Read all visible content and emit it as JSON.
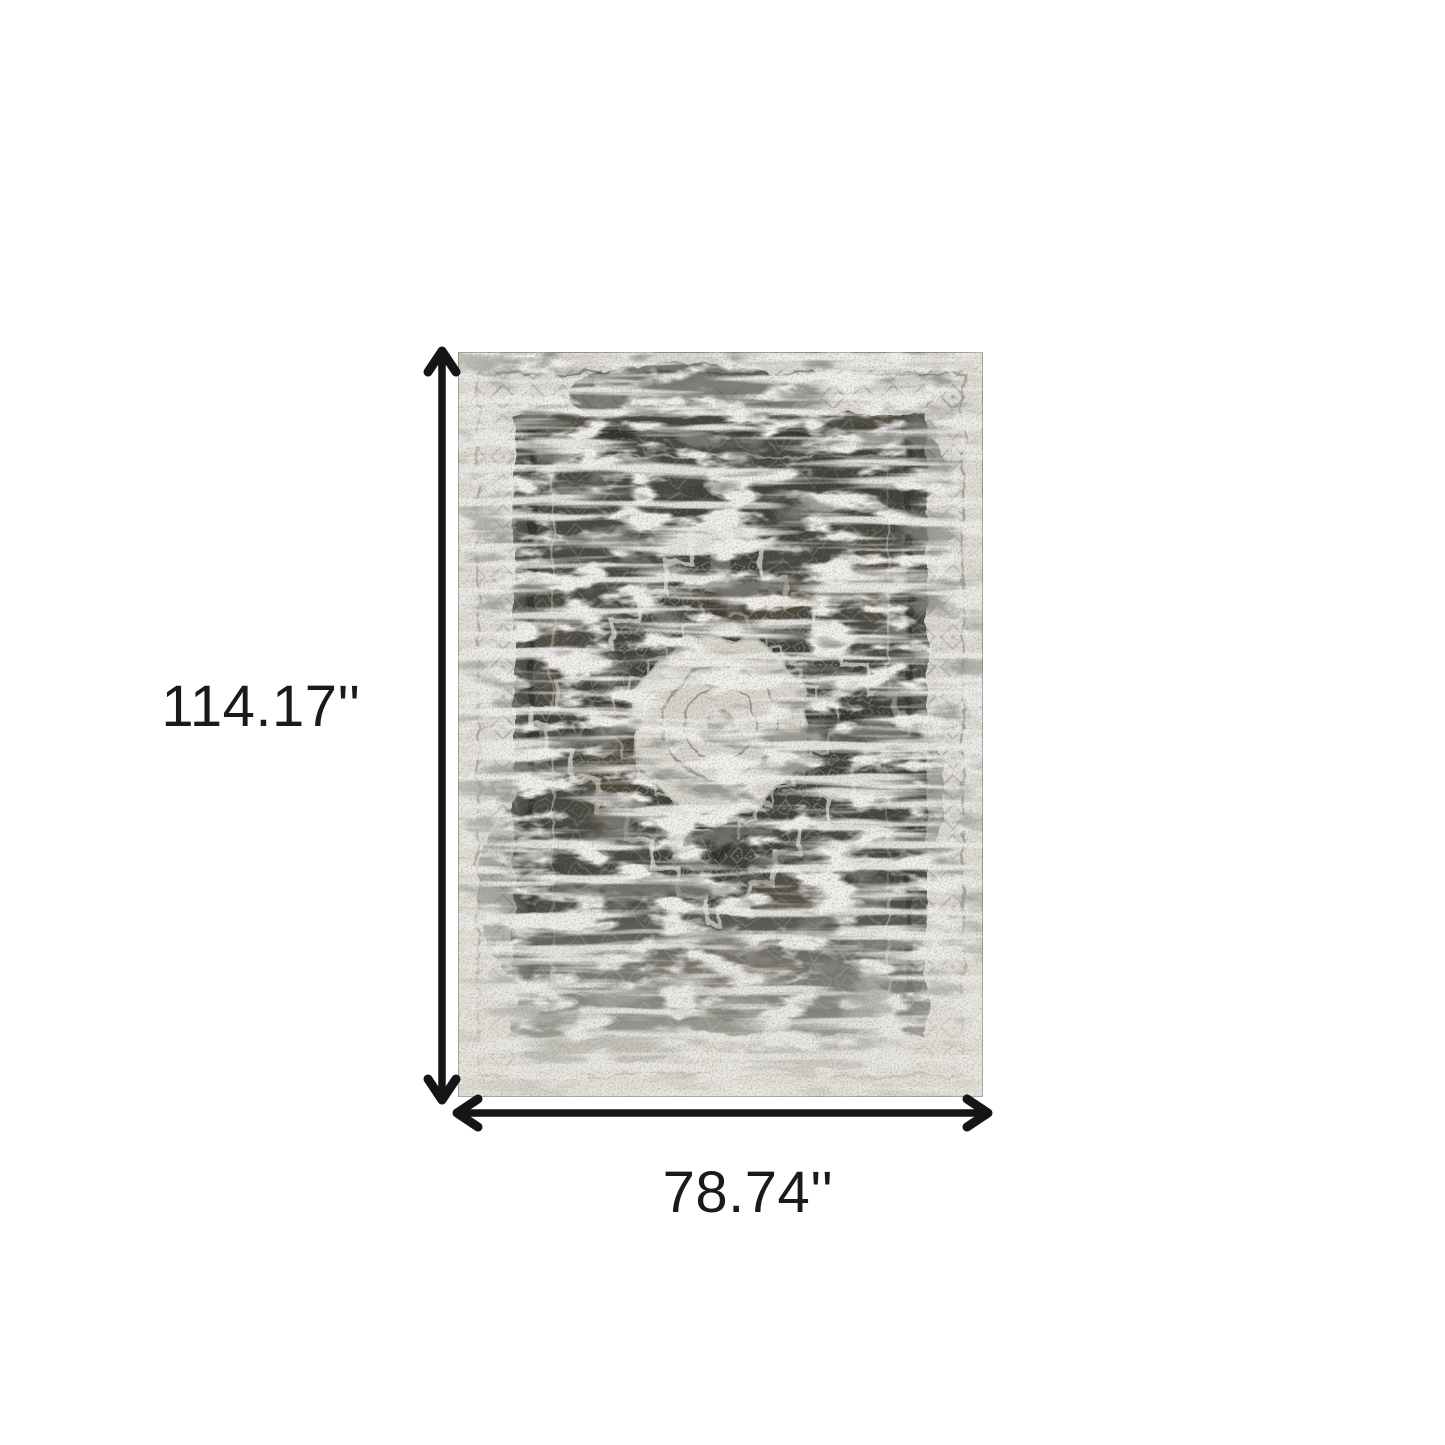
{
  "figure": {
    "height_label": "114.17''",
    "width_label": "78.74''",
    "arrow_color": "#151515",
    "text_color": "#1a1a1a",
    "background": "#ffffff",
    "rug_colors": {
      "base": "#dbd9d1",
      "field": "#45463f",
      "diamond": "#3d3f38",
      "medallion": "#d7d5cc",
      "rust": "#6e5742"
    }
  }
}
